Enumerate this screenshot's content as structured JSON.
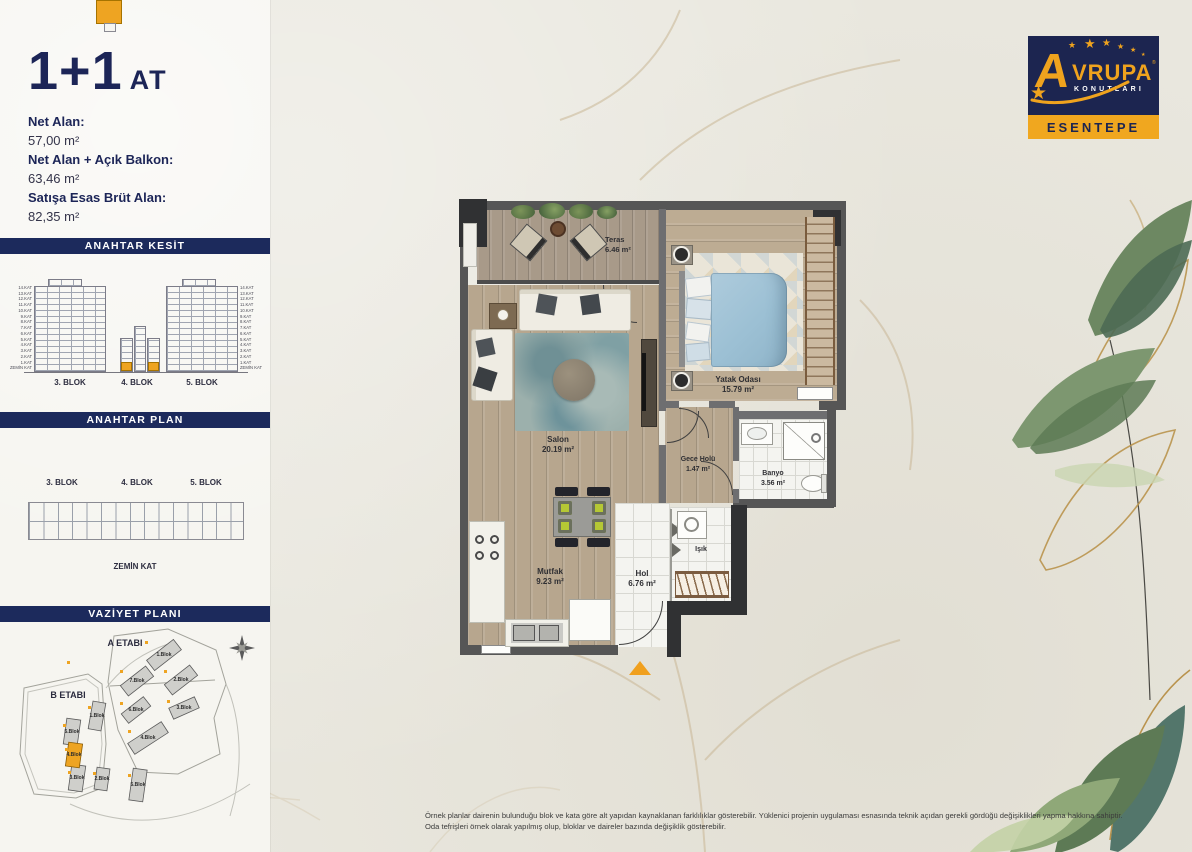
{
  "header": {
    "unit_size": "1+1",
    "unit_code": "AT"
  },
  "area_info": [
    {
      "label": "Net Alan:",
      "value": "57,00 m²"
    },
    {
      "label": "Net Alan + Açık Balkon:",
      "value": "63,46 m²"
    },
    {
      "label": "Satışa Esas Brüt Alan:",
      "value": "82,35 m²"
    }
  ],
  "anahtar_kesit": {
    "title": "ANAHTAR KESİT",
    "blocks": [
      "3. BLOK",
      "4. BLOK",
      "5. BLOK"
    ],
    "floors": [
      "14.KAT",
      "13.KAT",
      "12.KAT",
      "11.KAT",
      "10.KAT",
      "9.KAT",
      "8.KAT",
      "7.KAT",
      "6.KAT",
      "5.KAT",
      "4.KAT",
      "3.KAT",
      "2.KAT",
      "1.KAT",
      "ZEMİN KAT"
    ]
  },
  "anahtar_plan": {
    "title": "ANAHTAR PLAN",
    "blocks": [
      "3. BLOK",
      "4. BLOK",
      "5. BLOK"
    ],
    "floor": "ZEMİN KAT"
  },
  "vaziyet_plani": {
    "title": "VAZİYET PLANI",
    "stage_a": "A ETABI",
    "stage_b": "B ETABI",
    "a_blocks": [
      "1.Blok",
      "2.Blok",
      "3.Blok",
      "4.Blok",
      "5.Blok",
      "6.Blok",
      "7.Blok"
    ],
    "b_blocks": [
      "1.Blok",
      "2.Blok",
      "3.Blok",
      "4.Blok",
      "5.Blok"
    ],
    "highlighted_block": "4.Blok"
  },
  "brand": {
    "name_initial": "A",
    "name_rest": "VRUPA",
    "reg": "®",
    "subtitle": "KONUTLARI",
    "project": "ESENTEPE",
    "star": "★"
  },
  "floorplan": {
    "rooms": [
      {
        "name": "Teras",
        "area": "6.46 m²"
      },
      {
        "name": "Yatak Odası",
        "area": "15.79 m²"
      },
      {
        "name": "Salon",
        "area": "20.19 m²"
      },
      {
        "name": "Gece Holü",
        "area": "1.47 m²"
      },
      {
        "name": "Banyo",
        "area": "3.56 m²"
      },
      {
        "name": "Mutfak",
        "area": "9.23 m²"
      },
      {
        "name": "Hol",
        "area": "6.76 m²"
      },
      {
        "name": "Işık",
        "area": ""
      }
    ]
  },
  "footer": {
    "line1": "Örnek planlar dairenin bulunduğu blok ve kata göre alt yapıdan kaynaklanan farklılıklar gösterebilir. Yüklenici projenin uygulaması esnasında teknik açıdan gerekli gördüğü değişiklikleri yapma hakkına sahiptir.",
    "line2": "Oda tefrişleri örnek olarak yapılmış olup, bloklar ve daireler bazında değişiklik gösterebilir."
  },
  "colors": {
    "navy": "#1c2557",
    "orange": "#eea422",
    "wall_gray": "#565656",
    "paper": "#e9e7de"
  }
}
